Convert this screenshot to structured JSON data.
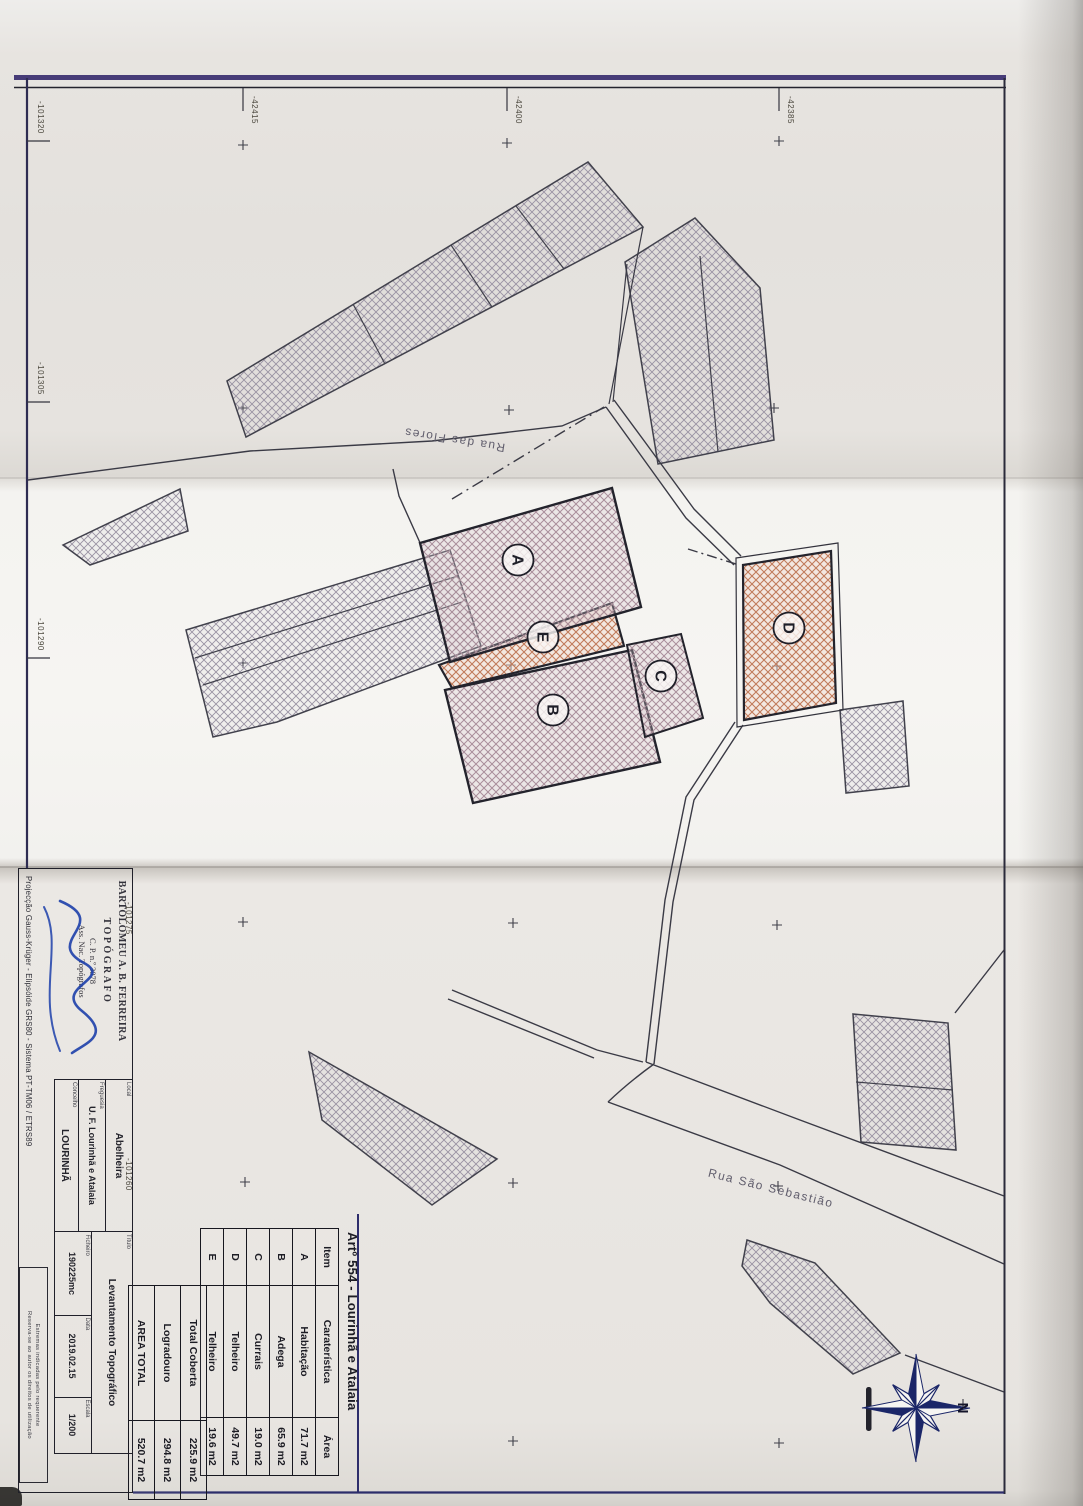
{
  "drawing": {
    "grid_top": [
      "-42415",
      "-42400",
      "-42385"
    ],
    "grid_left": [
      "-101320",
      "-101305",
      "-101290",
      "-101275",
      "-101260"
    ],
    "streets": {
      "flores": "Rua das Flores",
      "sebastiao": "Rua São Sebastião"
    },
    "buildings": [
      "A",
      "B",
      "C",
      "D",
      "E"
    ],
    "north_label": "N"
  },
  "area_table": {
    "title": "Artº 554 - Lourinhã e Atalaia",
    "headers": {
      "item": "Item",
      "feature": "Caraterística",
      "area": "Área"
    },
    "rows": [
      {
        "item": "A",
        "feature": "Habitação",
        "area": "71.7 m2"
      },
      {
        "item": "B",
        "feature": "Adega",
        "area": "65.9 m2"
      },
      {
        "item": "C",
        "feature": "Currais",
        "area": "19.0 m2"
      },
      {
        "item": "D",
        "feature": "Telheiro",
        "area": "49.7 m2"
      },
      {
        "item": "E",
        "feature": "Telheiro",
        "area": "19.6 m2"
      }
    ],
    "totals": [
      {
        "label": "Total Coberta",
        "area": "225.9 m2"
      },
      {
        "label": "Logradouro",
        "area": "294.8 m2"
      },
      {
        "label": "AREA TOTAL",
        "area": "520.7 m2"
      }
    ]
  },
  "title_block": {
    "stamp": [
      "BARTOLOMEU A. B. FERREIRA",
      "TOPÓGRAFO",
      "C. P. n.º 3078",
      "Ass. Nac. Topógrafos"
    ],
    "projection": "Projecção Gauss-Krüger - Elipsóide GRS80 - Sistema PT-TM06 / ETRS89",
    "fields": {
      "local_label": "Local",
      "local": "Abelheira",
      "freguesia_label": "Freguesia",
      "freguesia": "U. F. Lourinhã e Atalaia",
      "concelho_label": "Concelho",
      "concelho": "LOURINHÃ",
      "titulo_label": "Título",
      "titulo": "Levantamento Topográfico",
      "ficheiro_label": "Ficheiro",
      "ficheiro": "190225mc",
      "data_label": "Data",
      "data": "2019.02.15",
      "escala_label": "Escala",
      "escala": "1/200"
    },
    "notes": [
      "Estremas indicadas pelo requerente",
      "Reserva-se ao autor os direitos de utilização"
    ]
  },
  "colors": {
    "frame_blue": "#473c78",
    "line_dark": "#3a3a45",
    "hatch_gray": "#9992a2",
    "hatch_pink": "#a98e9a",
    "hatch_red": "#c07a5a",
    "signature_blue": "#1d3faa",
    "compass_navy": "#1b2668"
  }
}
